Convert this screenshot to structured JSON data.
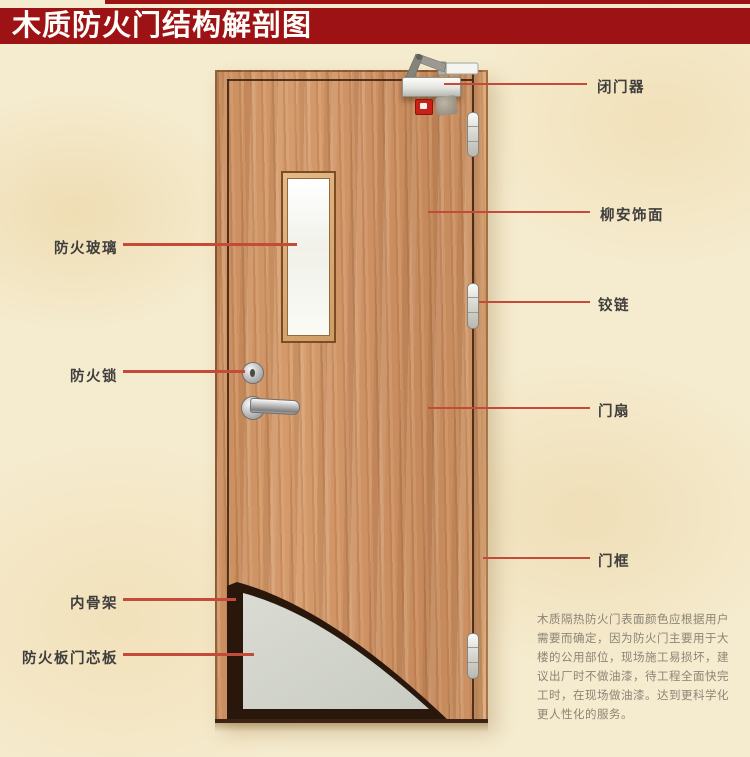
{
  "title": {
    "text": "木质防火门结构解剖图"
  },
  "labels": {
    "right": [
      {
        "text": "闭门器"
      },
      {
        "text": "柳安饰面"
      },
      {
        "text": "铰链"
      },
      {
        "text": "门扇"
      },
      {
        "text": "门框"
      }
    ],
    "left": [
      {
        "text": "防火玻璃"
      },
      {
        "text": "防火锁"
      },
      {
        "text": "内骨架"
      },
      {
        "text": "防火板门芯板"
      }
    ]
  },
  "description": {
    "lines": [
      "木质隔热防火门表面颜色应根据用户",
      "需要而确定，因为防火门主要用于大",
      "楼的公用部位，现场施工易损坏，建",
      "议出厂时不做油漆，待工程全面快完",
      "工时，在现场做油漆。达到更科学化",
      "更人性化的服务。"
    ]
  },
  "colors": {
    "banner_red": "#9d1315",
    "leader_line_red": "#c44b39",
    "wood": "#cd9164",
    "inner_skeleton_dark": "#2a170c",
    "core_board_grey": "#d4d6ce",
    "background_cream": "#f5ebce"
  }
}
